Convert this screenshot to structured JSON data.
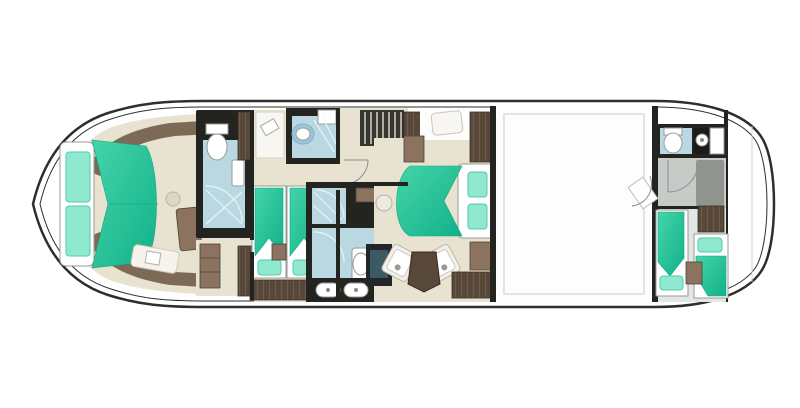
{
  "title": "motor-yacht-lower-deck-floor-plan",
  "colors": {
    "hull": "#2e2e2e",
    "wall": "#23231f",
    "cream": "#e8e2d1",
    "wood": "#7d6a56",
    "wood_mid": "#8b7360",
    "wood_dark": "#57483a",
    "teal_a": "#45d4a9",
    "teal_b": "#12b189",
    "teal_light": "#8fe8cf",
    "bath": "#b9d8e2",
    "bath2": "#9cc6d6",
    "gray_floor": "#c7cbc7",
    "gray_dark": "#90948f",
    "fixture": "#ffffff",
    "tv": "#3c5a66",
    "engine_line": "#c9ccce"
  },
  "rooms": [
    {
      "id": "bow-cabin",
      "furniture": [
        "double-bed",
        "pillow",
        "pillow",
        "stool",
        "vanity-desk",
        "bench-seat"
      ]
    },
    {
      "id": "forward-head",
      "furniture": [
        "toilet",
        "shower",
        "door"
      ]
    },
    {
      "id": "forward-closet",
      "furniture": [
        "wardrobe"
      ]
    },
    {
      "id": "twin-cabin",
      "furniture": [
        "single-bed",
        "single-bed",
        "pillow",
        "pillow",
        "nightstand",
        "dresser",
        "desk"
      ]
    },
    {
      "id": "twin-head",
      "furniture": [
        "washbasin",
        "counter",
        "shower"
      ]
    },
    {
      "id": "corridor",
      "furniture": [
        "staircase",
        "wardrobe",
        "door",
        "door"
      ]
    },
    {
      "id": "midship-head",
      "furniture": [
        "shower",
        "toilet",
        "washbasin",
        "washbasin",
        "vanity-counter"
      ]
    },
    {
      "id": "master-cabin",
      "furniture": [
        "double-bed",
        "pillow",
        "pillow",
        "armchair",
        "armchair",
        "table",
        "tv-cabinet",
        "wardrobe",
        "wardrobe",
        "seat",
        "stool"
      ]
    },
    {
      "id": "engine-room",
      "furniture": [
        "access-door"
      ]
    },
    {
      "id": "crew-cabin",
      "furniture": [
        "toilet",
        "washbasin",
        "counter",
        "shower",
        "berth",
        "berth",
        "pillow",
        "pillow",
        "nightstand",
        "cabinet"
      ]
    },
    {
      "id": "stern-platform",
      "furniture": []
    }
  ]
}
